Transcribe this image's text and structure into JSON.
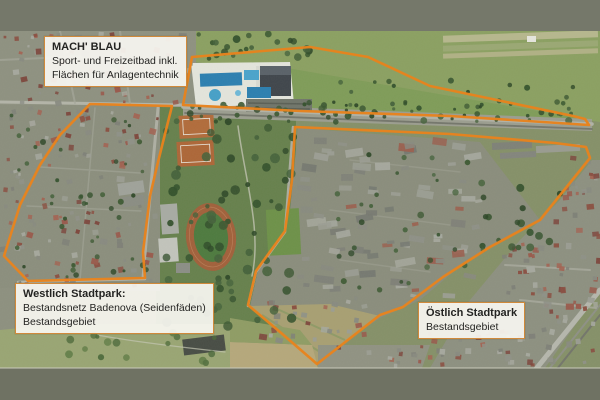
{
  "frame": {
    "top_bar_color": "#75786a",
    "bottom_bar_color": "#6f7263",
    "separator_color": "#c9cabb"
  },
  "map": {
    "accent_color": "#e8831d",
    "label_background": "#f7f6f1",
    "label_border_color": "#cd8330",
    "areas": [
      {
        "name": "mach-blau",
        "title": "MACH' BLAU",
        "lines": [
          "Sport- und Freizeitbad inkl.",
          "Flächen für Anlagentechnik"
        ],
        "outline": "192,57 310,47 368,57 430,86 573,116 585,119 589,125 450,116 300,111 183,105"
      },
      {
        "name": "westlich-stadtpark",
        "title": "Westlich Stadtpark:",
        "lines": [
          "Bestandsnetz Badenova (Seidenfäden)",
          "Bestandsgebiet"
        ],
        "outline": "90,104 172,106 158,162 150,196 143,252 145,278 28,281 4,256 20,205 40,165 60,135"
      },
      {
        "name": "oestlich-stadtpark",
        "title": "Östlich Stadtpark",
        "lines": [
          "Bestandsgebiet"
        ],
        "outline": "295,127 450,134 555,143 586,147 590,158 540,220 490,247 443,277 403,307 380,315 317,364 280,332 248,305 256,271 285,231 292,180"
      }
    ]
  }
}
